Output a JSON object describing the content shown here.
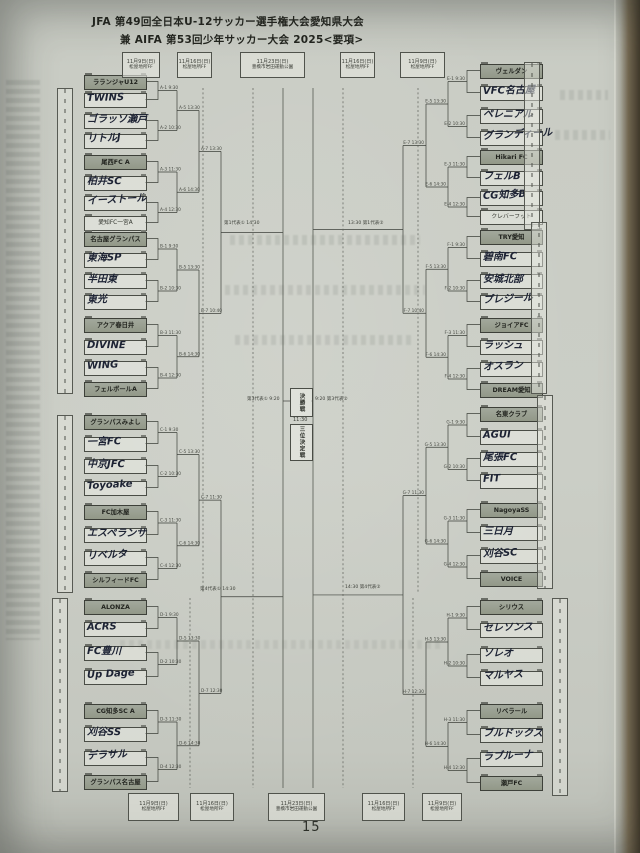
{
  "title": {
    "line1": "JFA 第49回全日本U-12サッカー選手権大会愛知県大会",
    "line2": "兼 AIFA 第53回少年サッカー大会 2025<要項>"
  },
  "page_number": "15",
  "schedule_top": [
    {
      "date": "11月9日(日)",
      "venue": "松屋地所FF"
    },
    {
      "date": "11月16日(日)",
      "venue": "松屋地所FF"
    },
    {
      "date": "11月23日(日)",
      "venue": "豊橋市岩田運動公園"
    },
    {
      "date": "11月16日(日)",
      "venue": "松屋地所FF"
    },
    {
      "date": "11月9日(日)",
      "venue": "松屋地所FF"
    }
  ],
  "schedule_bottom": [
    {
      "date": "11月9日(日)",
      "venue": "松屋地所FF"
    },
    {
      "date": "11月16日(日)",
      "venue": "松屋地所FF"
    },
    {
      "date": "11月23日(日)",
      "venue": "豊橋市岩田運動公園"
    },
    {
      "date": "11月16日(日)",
      "venue": "松屋地所FF"
    },
    {
      "date": "11月9日(日)",
      "venue": "松屋地所FF"
    }
  ],
  "center": {
    "final_label": "決勝戦",
    "final_time": "11:30",
    "third_place_label": "三位決定戦",
    "semi_left_label": "第3代表① 9:20",
    "semi_right_label": "9:20 第3代表②"
  },
  "qualifiers": {
    "top_left": "第1代表① 14:30",
    "top_right": "13:30 第1代表②",
    "bottom_left": "第4代表① 14:30",
    "bottom_right": "14:30 第4代表②"
  },
  "round_times": {
    "r1": [
      "9:30",
      "10:30",
      "11:30",
      "12:30"
    ],
    "r2": [
      "13:30",
      "14:30"
    ],
    "group_final": {
      "A": "13:30",
      "B": "10:40",
      "C": "11:30",
      "D": "12:30",
      "E": "13:30",
      "F": "10:40",
      "G": "11:30",
      "H": "12:30"
    }
  },
  "bracket": {
    "groups": [
      {
        "id": "A",
        "side": "left",
        "teams": [
          {
            "name": "ラランジャU12",
            "style": "seeded"
          },
          {
            "name": "TWINS",
            "style": "hand"
          },
          {
            "name": "ゴラッソ瀬戸",
            "style": "hand"
          },
          {
            "name": "リトルJ",
            "style": "hand"
          },
          {
            "name": "尾西FC A",
            "style": "seeded"
          },
          {
            "name": "柏井SC",
            "style": "hand"
          },
          {
            "name": "イーストール",
            "style": "hand"
          },
          {
            "name": "愛知FC一宮A",
            "style": "printed"
          }
        ]
      },
      {
        "id": "B",
        "side": "left",
        "teams": [
          {
            "name": "名古屋グランパス",
            "style": "seeded"
          },
          {
            "name": "東海SP",
            "style": "hand"
          },
          {
            "name": "半田東",
            "style": "hand"
          },
          {
            "name": "東光",
            "style": "hand"
          },
          {
            "name": "アクア春日井",
            "style": "seeded"
          },
          {
            "name": "DIVINE",
            "style": "hand"
          },
          {
            "name": "WING",
            "style": "hand"
          },
          {
            "name": "フェルボールA",
            "style": "seeded"
          }
        ]
      },
      {
        "id": "C",
        "side": "left",
        "teams": [
          {
            "name": "グランパスみよし",
            "style": "seeded"
          },
          {
            "name": "一宮FC",
            "style": "hand"
          },
          {
            "name": "中京JFC",
            "style": "hand"
          },
          {
            "name": "Toyoake",
            "style": "hand"
          },
          {
            "name": "FC加木屋",
            "style": "seeded"
          },
          {
            "name": "エスペランサ",
            "style": "hand"
          },
          {
            "name": "リベルタ",
            "style": "hand"
          },
          {
            "name": "シルフィードFC",
            "style": "seeded"
          }
        ]
      },
      {
        "id": "D",
        "side": "left",
        "teams": [
          {
            "name": "ALONZA",
            "style": "seeded"
          },
          {
            "name": "ACRS",
            "style": "hand"
          },
          {
            "name": "FC豊川",
            "style": "hand"
          },
          {
            "name": "Up Dage",
            "style": "hand"
          },
          {
            "name": "CG知多SC A",
            "style": "seeded"
          },
          {
            "name": "刈谷SS",
            "style": "hand"
          },
          {
            "name": "デラサル",
            "style": "hand"
          },
          {
            "name": "グランパス名古屋",
            "style": "seeded"
          }
        ]
      },
      {
        "id": "E",
        "side": "right",
        "teams": [
          {
            "name": "ヴェルダン",
            "style": "seeded"
          },
          {
            "name": "VFC名古屋",
            "style": "hand"
          },
          {
            "name": "ペレニアル",
            "style": "hand"
          },
          {
            "name": "グランディール",
            "style": "hand"
          },
          {
            "name": "Hikari FC",
            "style": "seeded"
          },
          {
            "name": "フェルB",
            "style": "hand"
          },
          {
            "name": "CG知多B",
            "style": "hand"
          },
          {
            "name": "クレバーフット",
            "style": "printed"
          }
        ]
      },
      {
        "id": "F",
        "side": "right",
        "teams": [
          {
            "name": "TRY愛知",
            "style": "seeded"
          },
          {
            "name": "碧南FC",
            "style": "hand"
          },
          {
            "name": "安城北部",
            "style": "hand"
          },
          {
            "name": "プレジール",
            "style": "hand"
          },
          {
            "name": "ジョイアFC",
            "style": "seeded"
          },
          {
            "name": "ラッシュ",
            "style": "hand"
          },
          {
            "name": "オスラン",
            "style": "hand"
          },
          {
            "name": "DREAM愛知",
            "style": "seeded"
          }
        ]
      },
      {
        "id": "G",
        "side": "right",
        "teams": [
          {
            "name": "名東クラブ",
            "style": "seeded"
          },
          {
            "name": "AGUI",
            "style": "hand"
          },
          {
            "name": "尾張FC",
            "style": "hand"
          },
          {
            "name": "FIT",
            "style": "hand"
          },
          {
            "name": "NagoyaSS",
            "style": "seeded"
          },
          {
            "name": "三日月",
            "style": "hand"
          },
          {
            "name": "刈谷SC",
            "style": "hand"
          },
          {
            "name": "VOICE",
            "style": "seeded"
          }
        ]
      },
      {
        "id": "H",
        "side": "right",
        "teams": [
          {
            "name": "シリウス",
            "style": "seeded"
          },
          {
            "name": "セレソンス",
            "style": "hand"
          },
          {
            "name": "ソレオ",
            "style": "hand"
          },
          {
            "name": "マルヤス",
            "style": "hand"
          },
          {
            "name": "リベラール",
            "style": "seeded"
          },
          {
            "name": "ブルドックス",
            "style": "hand"
          },
          {
            "name": "ラブルーナ",
            "style": "hand"
          },
          {
            "name": "瀬戸FC",
            "style": "seeded"
          }
        ]
      }
    ]
  },
  "colors": {
    "paper": "#c9ccc4",
    "ink": "#2b2e29",
    "handwriting": "#1d2334",
    "seeded_fill": "#9aa094"
  }
}
